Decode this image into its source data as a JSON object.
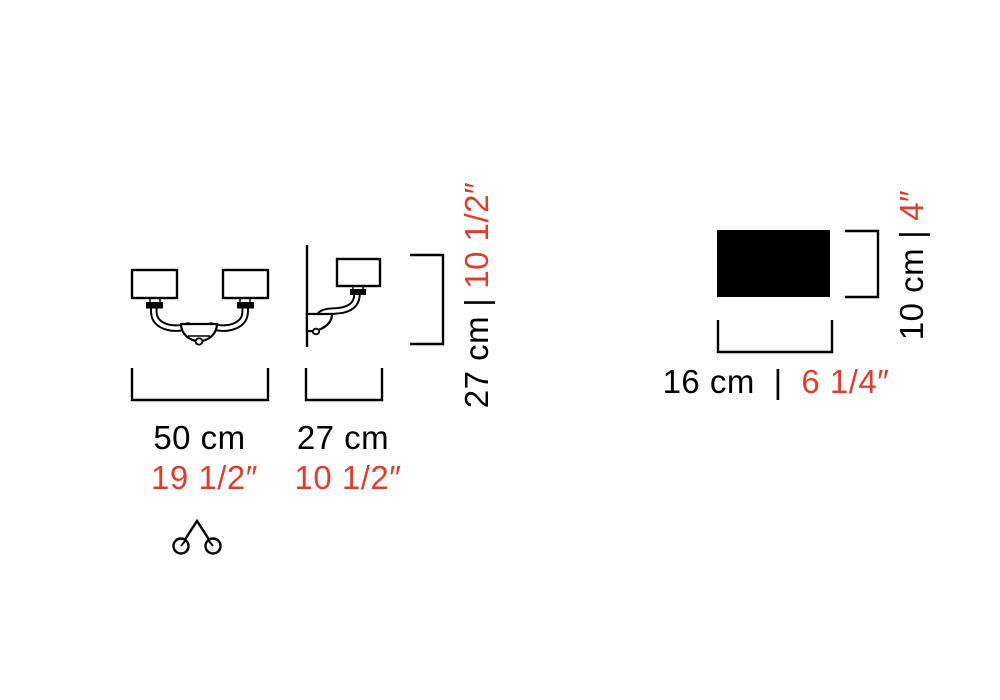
{
  "colors": {
    "line": "#000000",
    "text_primary": "#000000",
    "accent_red": "#e23c2d",
    "solid_fill": "#000000"
  },
  "diagram": {
    "front_view": {
      "width": {
        "metric": "50 cm",
        "imperial": "19 1/2″"
      }
    },
    "side_view": {
      "depth": {
        "metric": "27 cm",
        "imperial": "10 1/2″"
      },
      "height": {
        "metric": "27 cm",
        "separator": "|",
        "imperial": "10 1/2″"
      }
    },
    "top_view": {
      "width": {
        "metric": "16 cm",
        "separator": "|",
        "imperial": "6 1/4″"
      },
      "depth": {
        "metric": "10 cm",
        "separator": "|",
        "imperial": "4″"
      }
    },
    "bulb_count_icon": {
      "bulbs": 2
    }
  }
}
